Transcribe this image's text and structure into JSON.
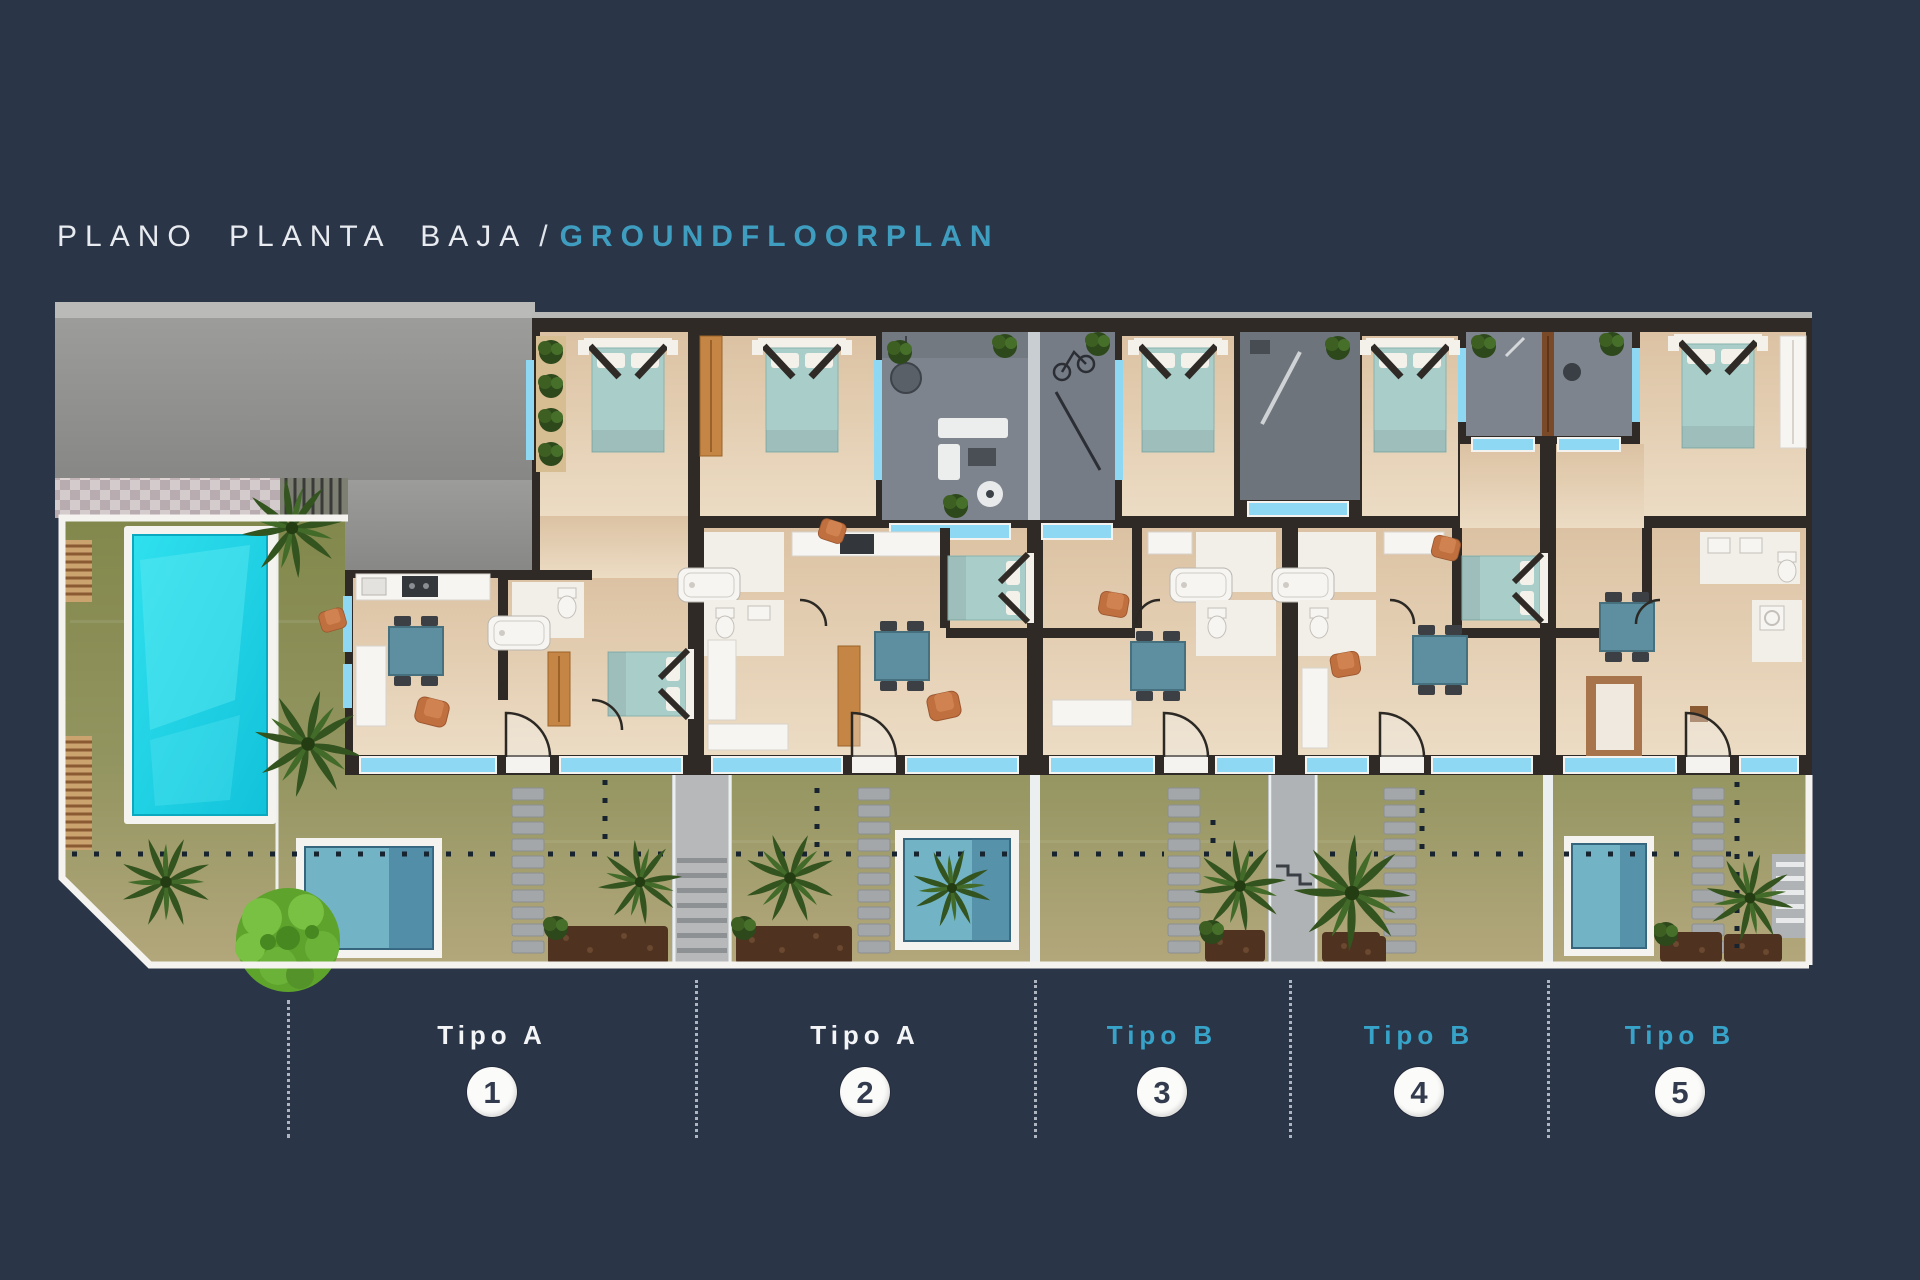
{
  "title": {
    "primary": "PLANO PLANTA BAJA",
    "separator": "/",
    "secondary": "GROUNDFLOORPLAN"
  },
  "units": [
    {
      "type": "Tipo A",
      "number": "1"
    },
    {
      "type": "Tipo A",
      "number": "2"
    },
    {
      "type": "Tipo B",
      "number": "3"
    },
    {
      "type": "Tipo B",
      "number": "4"
    },
    {
      "type": "Tipo B",
      "number": "5"
    }
  ],
  "plan": {
    "kind": "ground-floor-plan",
    "features": [
      "driveway",
      "communal-garden",
      "swimming-pool",
      "plunge-pools",
      "private-gardens",
      "entry-patios",
      "stepping-stone-paths",
      "staircase",
      "ramp",
      "palm-trees",
      "tree",
      "mulch-beds",
      "terrace-windows",
      "bedrooms",
      "bathrooms",
      "kitchens",
      "dining-sets"
    ],
    "colors": {
      "background": "#2b3548",
      "title_primary": "#e8ecf0",
      "title_accent": "#3f9ec0",
      "type_a_label": "#f3f5f7",
      "type_b_label": "#37a3c8",
      "badge_background": "#fbfbfa",
      "badge_text": "#333c4e",
      "swimming_pool": "#1fd2e6",
      "plunge_pool": "#72b4c6",
      "garden": "#8b9054",
      "floor": "#e3cdb0",
      "wall": "#2f2a26",
      "window": "#8fd8f3",
      "patio": "#7d848d",
      "driveway": "#919190"
    }
  }
}
